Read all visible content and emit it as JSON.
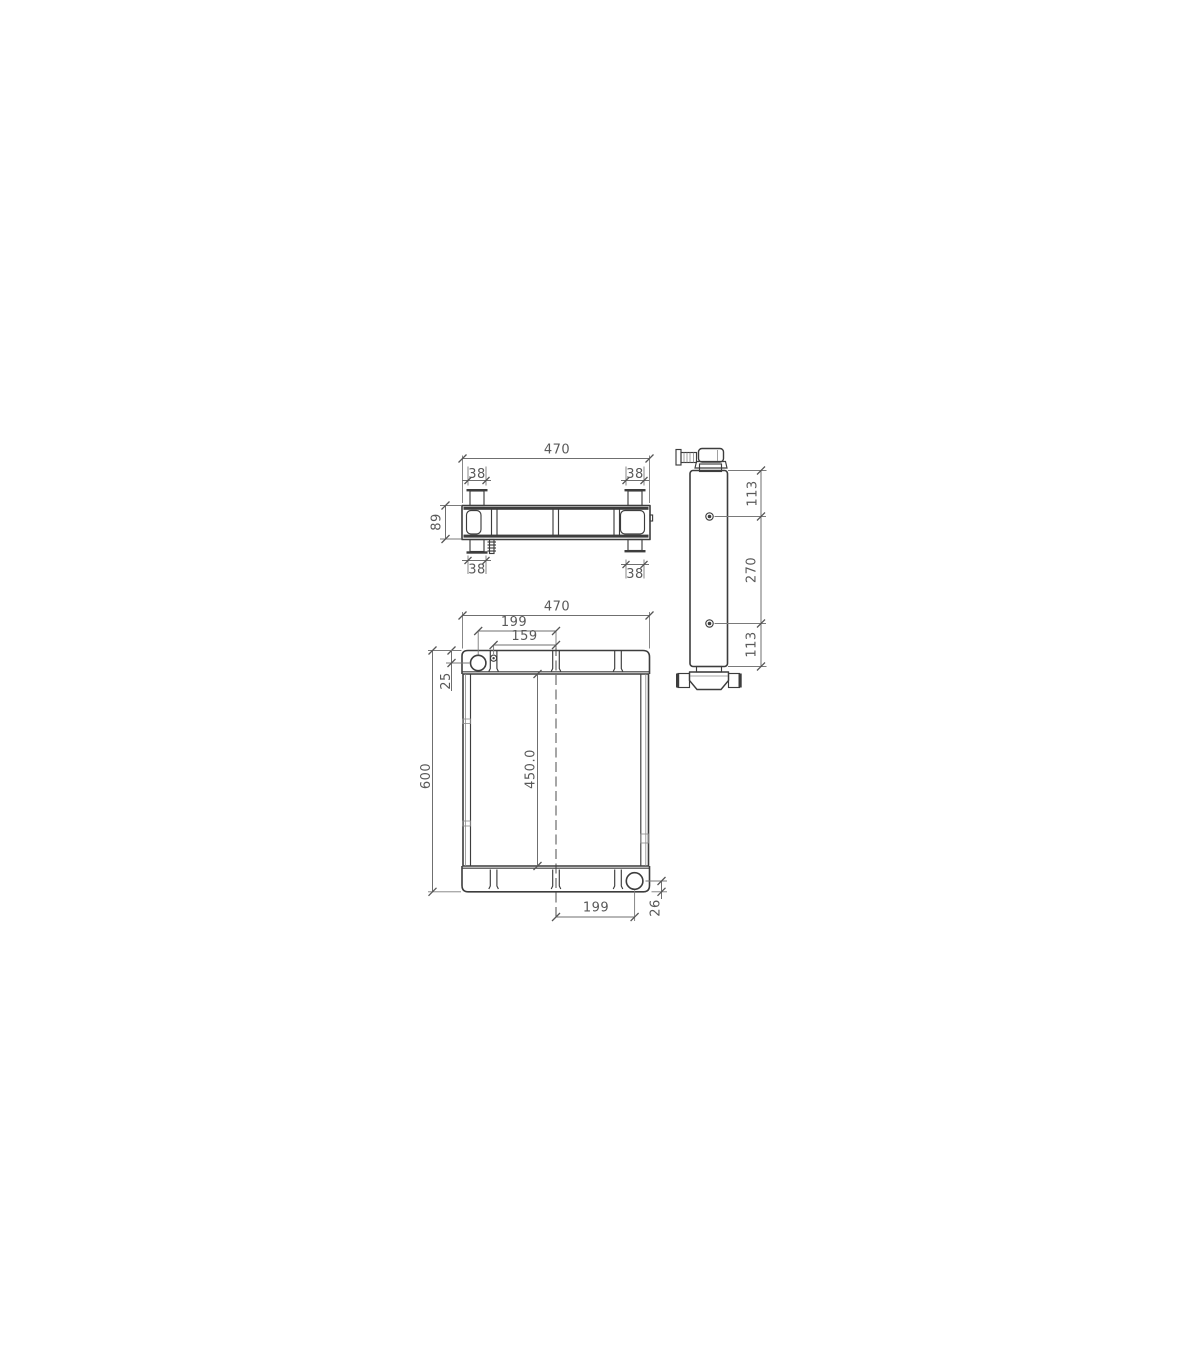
{
  "drawing": {
    "background_color": "#ffffff",
    "line_color": "#3d3d3d",
    "dimension_color": "#6f6f6f",
    "text_color": "#595959",
    "top_view": {
      "overall_width": "470",
      "bracket_top_left_width": "38",
      "bracket_top_right_width": "38",
      "depth": "89",
      "bracket_bottom_left_width": "38",
      "bracket_bottom_right_width": "38"
    },
    "front_view": {
      "overall_width": "470",
      "filler_center_offset": "199",
      "bolt_center_offset": "159",
      "filler_top_offset": "25",
      "overall_height": "600",
      "core_height": "450.0",
      "outlet_center_offset": "199",
      "outlet_bottom_offset": "26"
    },
    "side_view": {
      "top_hole_offset": "113",
      "hole_spacing": "270",
      "bottom_hole_offset": "113"
    }
  }
}
